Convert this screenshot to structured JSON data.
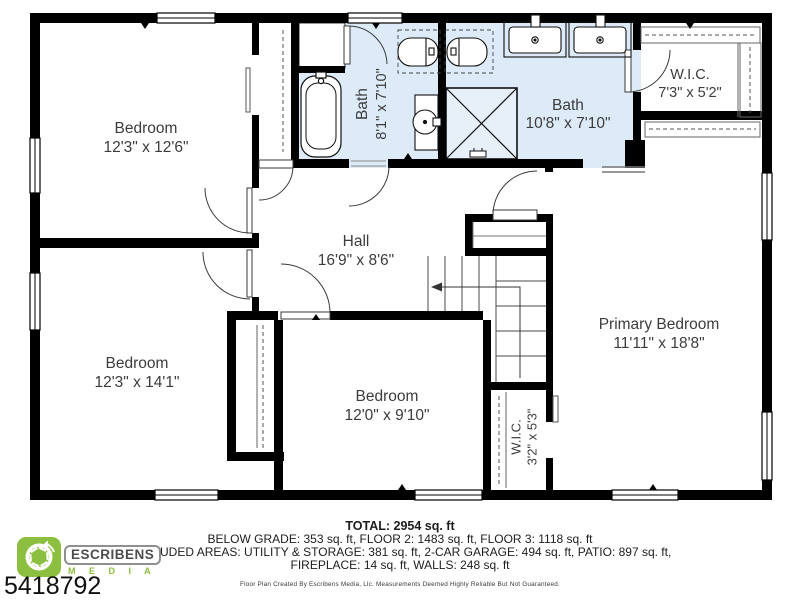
{
  "plan": {
    "rooms": [
      {
        "id": "bedroom-top-left",
        "name": "Bedroom",
        "dims": "12'3\" x 12'6\""
      },
      {
        "id": "bedroom-bottom-left",
        "name": "Bedroom",
        "dims": "12'3\" x 14'1\""
      },
      {
        "id": "bedroom-bottom-middle",
        "name": "Bedroom",
        "dims": "12'0\" x 9'10\""
      },
      {
        "id": "primary-bedroom",
        "name": "Primary Bedroom",
        "dims": "11'11\" x 18'8\""
      },
      {
        "id": "hall",
        "name": "Hall",
        "dims": "16'9\" x 8'6\""
      },
      {
        "id": "bath-small",
        "name": "Bath",
        "dims": "8'1\" x 7'10\""
      },
      {
        "id": "bath-main",
        "name": "Bath",
        "dims": "10'8\" x 7'10\""
      },
      {
        "id": "wic-top-right",
        "name": "W.I.C.",
        "dims": "7'3\" x 5'2\""
      },
      {
        "id": "wic-small",
        "name": "W.I.C.",
        "dims": "3'2\" x 5'3\""
      }
    ],
    "bath_floor_color": "#dcebf7"
  },
  "footer": {
    "total": "TOTAL: 2954 sq. ft",
    "line2": "BELOW GRADE: 353 sq. ft, FLOOR 2: 1483 sq. ft, FLOOR 3: 1118 sq. ft",
    "line3": "EXCLUDED AREAS: UTILITY & STORAGE: 381 sq. ft, 2-CAR GARAGE: 494 sq. ft, PATIO: 897 sq. ft,",
    "line4": "FIREPLACE: 14 sq. ft, WALLS: 248 sq. ft",
    "disclaimer": "Floor Plan Created By Escribens Media, Llc. Measurements Deemed Highly Reliable But Not Guaranteed."
  },
  "branding": {
    "logo_name": "ESCRIBENS",
    "logo_sub": "M E D I A",
    "listing_number": "5418792",
    "brand_green": "#8cbf3f"
  }
}
